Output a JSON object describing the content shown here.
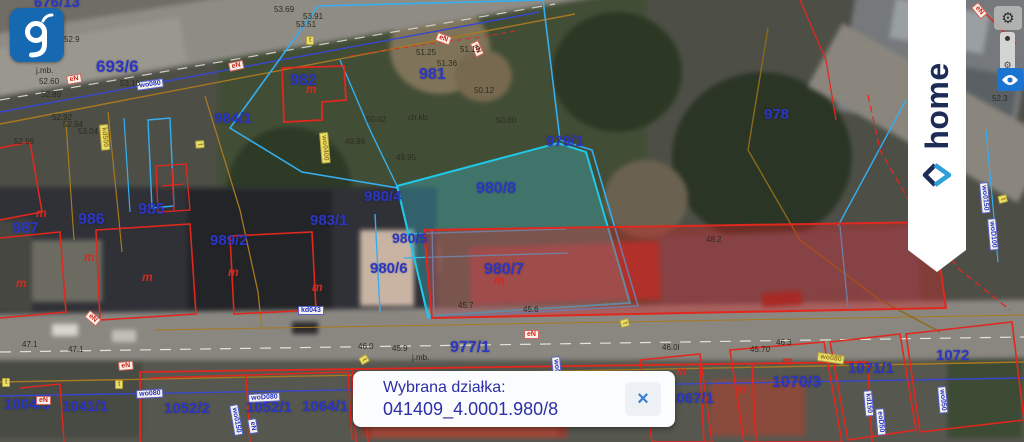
{
  "branding": {
    "geoportal_logo_letter": "g",
    "home_label": "home"
  },
  "controls": {
    "settings_icon": "⚙",
    "layers_icon": "⚙"
  },
  "popup": {
    "title": "Wybrana działka:",
    "parcel_id": "041409_4.0001.980/8",
    "close_icon": "×"
  },
  "colors": {
    "selected_parcel_fill": "#3cd2e6",
    "parcel_label": "#2b36c3",
    "boundary_red": "#e0281e",
    "boundary_cyan": "#35aef0",
    "popup_text": "#2c2fa6"
  },
  "map": {
    "building_mark_char": "m",
    "parcels": [
      {
        "t": "676/13",
        "x": 34,
        "y": -5,
        "s": 15
      },
      {
        "t": "693/6",
        "x": 96,
        "y": 58,
        "s": 17
      },
      {
        "t": "982",
        "x": 290,
        "y": 73,
        "s": 16
      },
      {
        "t": "984/1",
        "x": 214,
        "y": 111,
        "s": 15
      },
      {
        "t": "981",
        "x": 419,
        "y": 67,
        "s": 16
      },
      {
        "t": "979/1",
        "x": 546,
        "y": 134,
        "s": 15
      },
      {
        "t": "978",
        "x": 764,
        "y": 107,
        "s": 15
      },
      {
        "t": "980/8",
        "x": 476,
        "y": 181,
        "s": 16
      },
      {
        "t": "980/4",
        "x": 364,
        "y": 189,
        "s": 15
      },
      {
        "t": "983/1",
        "x": 310,
        "y": 213,
        "s": 15
      },
      {
        "t": "985",
        "x": 138,
        "y": 202,
        "s": 16
      },
      {
        "t": "986",
        "x": 78,
        "y": 212,
        "s": 16
      },
      {
        "t": "987",
        "x": 12,
        "y": 221,
        "s": 16
      },
      {
        "t": "989/2",
        "x": 210,
        "y": 233,
        "s": 15
      },
      {
        "t": "980/5",
        "x": 392,
        "y": 231,
        "s": 14
      },
      {
        "t": "980/6",
        "x": 370,
        "y": 261,
        "s": 15
      },
      {
        "t": "980/7",
        "x": 484,
        "y": 262,
        "s": 16
      },
      {
        "t": "977/1",
        "x": 450,
        "y": 340,
        "s": 16
      },
      {
        "t": "1004/3",
        "x": 4,
        "y": 397,
        "s": 15
      },
      {
        "t": "1041/1",
        "x": 62,
        "y": 399,
        "s": 15
      },
      {
        "t": "1052/2",
        "x": 164,
        "y": 401,
        "s": 15
      },
      {
        "t": "1052/1",
        "x": 246,
        "y": 400,
        "s": 15
      },
      {
        "t": "1064/1",
        "x": 302,
        "y": 399,
        "s": 15
      },
      {
        "t": "1067/1",
        "x": 668,
        "y": 391,
        "s": 15
      },
      {
        "t": "1070/3",
        "x": 772,
        "y": 375,
        "s": 16
      },
      {
        "t": "1071/1",
        "x": 848,
        "y": 361,
        "s": 15
      },
      {
        "t": "1072",
        "x": 936,
        "y": 348,
        "s": 15
      }
    ],
    "building_marks": [
      {
        "x": 306,
        "y": 83
      },
      {
        "x": 36,
        "y": 207
      },
      {
        "x": 16,
        "y": 277
      },
      {
        "x": 142,
        "y": 271
      },
      {
        "x": 228,
        "y": 266
      },
      {
        "x": 312,
        "y": 281
      },
      {
        "x": 494,
        "y": 274
      },
      {
        "x": 676,
        "y": 365
      },
      {
        "x": 782,
        "y": 355
      },
      {
        "x": 736,
        "y": 383
      },
      {
        "x": 84,
        "y": 251
      },
      {
        "x": 628,
        "y": 378
      }
    ],
    "utilities": [
      {
        "t": "wo080",
        "x": 136,
        "y": 82,
        "c": "blue",
        "r": -8
      },
      {
        "t": "eN",
        "x": 66,
        "y": 76,
        "c": "red",
        "r": -10
      },
      {
        "t": "eN",
        "x": 228,
        "y": 63,
        "c": "red",
        "r": -12
      },
      {
        "t": "t",
        "x": 306,
        "y": 36,
        "c": "yellow",
        "r": 0
      },
      {
        "t": "eN",
        "x": 438,
        "y": 32,
        "c": "red",
        "r": 20
      },
      {
        "t": "eN",
        "x": 478,
        "y": 40,
        "c": "red",
        "r": 65
      },
      {
        "t": "wo0400",
        "x": 328,
        "y": 132,
        "c": "yellow",
        "r": 85
      },
      {
        "t": "kd500",
        "x": 108,
        "y": 124,
        "c": "yellow",
        "r": 85
      },
      {
        "t": "t",
        "x": 204,
        "y": 140,
        "c": "yellow",
        "r": 85
      },
      {
        "t": "kd043",
        "x": 298,
        "y": 306,
        "c": "blue",
        "r": 0
      },
      {
        "t": "eN",
        "x": 90,
        "y": 310,
        "c": "red",
        "r": 40
      },
      {
        "t": "wo080",
        "x": 136,
        "y": 390,
        "c": "blue",
        "r": -3
      },
      {
        "t": "woD080",
        "x": 248,
        "y": 394,
        "c": "blue",
        "r": -3
      },
      {
        "t": "woA100",
        "x": 632,
        "y": 393,
        "c": "blue",
        "r": -2
      },
      {
        "t": "eN",
        "x": 36,
        "y": 396,
        "c": "red",
        "r": 0
      },
      {
        "t": "eN",
        "x": 118,
        "y": 362,
        "c": "red",
        "r": -5
      },
      {
        "t": "eN",
        "x": 524,
        "y": 330,
        "c": "red",
        "r": 0
      },
      {
        "t": "wo0500",
        "x": 560,
        "y": 356,
        "c": "blue",
        "r": 85
      },
      {
        "t": "t",
        "x": 628,
        "y": 318,
        "c": "yellow",
        "r": 75
      },
      {
        "t": "t",
        "x": 366,
        "y": 354,
        "c": "yellow",
        "r": 60
      },
      {
        "t": "wo0150",
        "x": 238,
        "y": 404,
        "c": "blue",
        "r": 80
      },
      {
        "t": "eN",
        "x": 256,
        "y": 418,
        "c": "blue",
        "r": 80
      },
      {
        "t": "t",
        "x": 115,
        "y": 380,
        "c": "yellow",
        "r": 0
      },
      {
        "t": "t",
        "x": 2,
        "y": 378,
        "c": "yellow",
        "r": 0
      },
      {
        "t": "kd150",
        "x": 872,
        "y": 390,
        "c": "blue",
        "r": 85
      },
      {
        "t": "eoD50",
        "x": 884,
        "y": 408,
        "c": "blue",
        "r": 85
      },
      {
        "t": "wo050",
        "x": 946,
        "y": 386,
        "c": "blue",
        "r": 85
      },
      {
        "t": "wo080",
        "x": 818,
        "y": 352,
        "c": "yellow",
        "r": 8
      },
      {
        "t": "wo0150",
        "x": 988,
        "y": 182,
        "c": "blue",
        "r": 85
      },
      {
        "t": "woD100",
        "x": 996,
        "y": 218,
        "c": "blue",
        "r": 85
      },
      {
        "t": "t",
        "x": 1006,
        "y": 194,
        "c": "yellow",
        "r": 75
      },
      {
        "t": "eN",
        "x": 978,
        "y": 2,
        "c": "red",
        "r": 50
      }
    ],
    "measurements": [
      {
        "t": "52.50",
        "x": 28,
        "y": 56
      },
      {
        "t": "j.mb.",
        "x": 36,
        "y": 67
      },
      {
        "t": "52.60",
        "x": 39,
        "y": 78
      },
      {
        "t": "52.89",
        "x": 41,
        "y": 91
      },
      {
        "t": "52.9",
        "x": 64,
        "y": 36
      },
      {
        "t": "53.69",
        "x": 274,
        "y": 6
      },
      {
        "t": "53.91",
        "x": 303,
        "y": 13
      },
      {
        "t": "53.51",
        "x": 296,
        "y": 21
      },
      {
        "t": "53.16",
        "x": 120,
        "y": 80
      },
      {
        "t": "52.92",
        "x": 52,
        "y": 114
      },
      {
        "t": "52.94",
        "x": 63,
        "y": 121
      },
      {
        "t": "53.04",
        "x": 78,
        "y": 128
      },
      {
        "t": "52.96",
        "x": 14,
        "y": 138
      },
      {
        "t": "52.3",
        "x": 992,
        "y": 95
      },
      {
        "t": "51.25",
        "x": 416,
        "y": 49
      },
      {
        "t": "51.19",
        "x": 460,
        "y": 46
      },
      {
        "t": "51.36",
        "x": 437,
        "y": 60
      },
      {
        "t": "50.12",
        "x": 474,
        "y": 87
      },
      {
        "t": "ch.kb.",
        "x": 408,
        "y": 114
      },
      {
        "t": "50.02",
        "x": 366,
        "y": 116
      },
      {
        "t": "50.00",
        "x": 496,
        "y": 117
      },
      {
        "t": "49.98",
        "x": 345,
        "y": 138
      },
      {
        "t": "49.95",
        "x": 396,
        "y": 154
      },
      {
        "t": "48.2",
        "x": 706,
        "y": 236
      },
      {
        "t": "45.7",
        "x": 458,
        "y": 302
      },
      {
        "t": "45.6",
        "x": 523,
        "y": 306
      },
      {
        "t": "46.0",
        "x": 358,
        "y": 343
      },
      {
        "t": "45.9",
        "x": 392,
        "y": 345
      },
      {
        "t": "j.mb.",
        "x": 412,
        "y": 354
      },
      {
        "t": "46.0l",
        "x": 662,
        "y": 344
      },
      {
        "t": "45.70",
        "x": 750,
        "y": 346
      },
      {
        "t": "46.3",
        "x": 776,
        "y": 339
      },
      {
        "t": "47.1",
        "x": 22,
        "y": 341
      },
      {
        "t": "47.1",
        "x": 68,
        "y": 346
      }
    ]
  }
}
